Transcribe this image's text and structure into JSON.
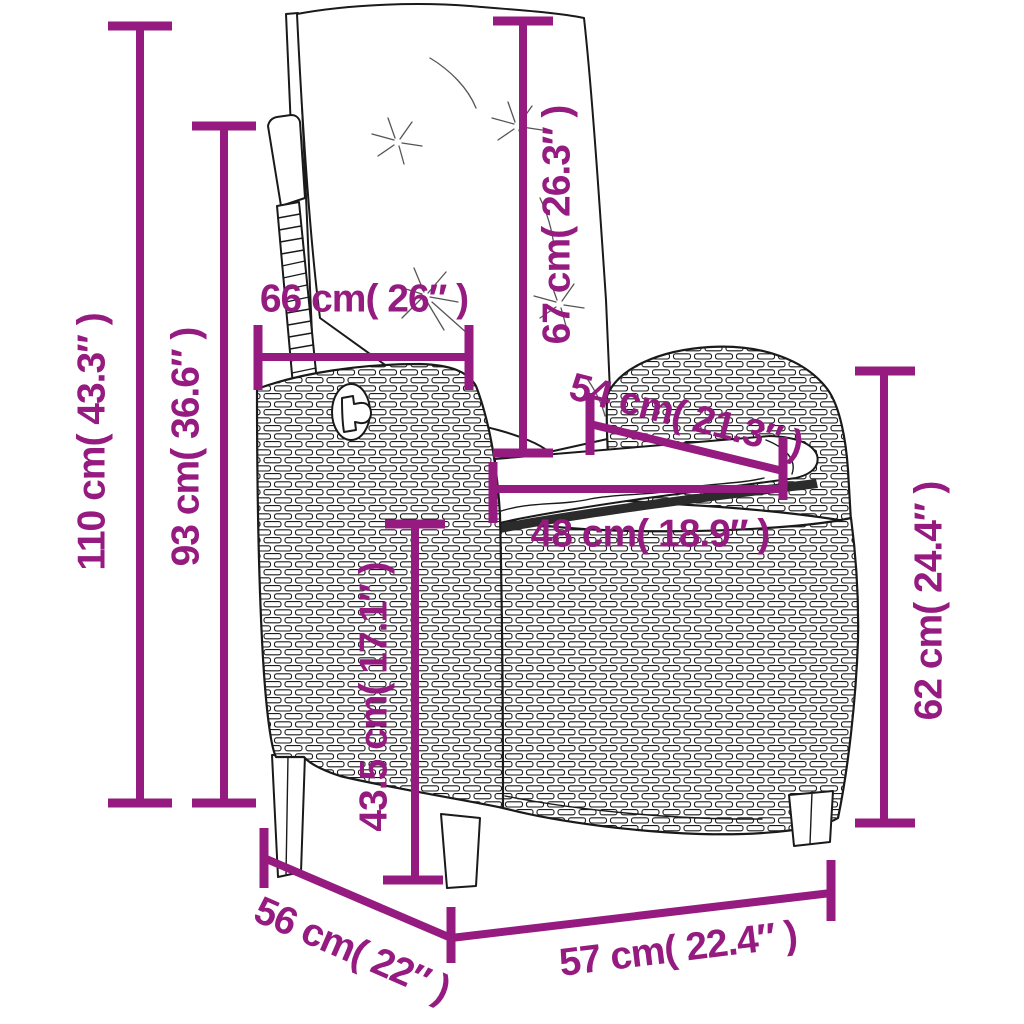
{
  "colors": {
    "dimension_accent": "#951B81",
    "line_art": "#1a1a1a",
    "background": "#ffffff"
  },
  "illustration": "reclining poly-rattan garden chair with back and seat cushions",
  "dimensions": [
    {
      "name": "overall-height",
      "label": "110 cm( 43.3″ )"
    },
    {
      "name": "backrest-height",
      "label": "93 cm( 36.6″ )"
    },
    {
      "name": "back-cushion-width",
      "label": "66 cm( 26″ )"
    },
    {
      "name": "back-cushion-length",
      "label": "67 cm( 26.3″ )"
    },
    {
      "name": "armrest-length",
      "label": "54 cm( 21.3″ )"
    },
    {
      "name": "seat-width",
      "label": "48 cm( 18.9″ )"
    },
    {
      "name": "seat-height",
      "label": "43.5 cm( 17.1″ )"
    },
    {
      "name": "armrest-height",
      "label": "62 cm( 24.4″ )"
    },
    {
      "name": "frame-depth",
      "label": "56 cm( 22″ )"
    },
    {
      "name": "frame-width",
      "label": "57 cm( 22.4″ )"
    }
  ]
}
